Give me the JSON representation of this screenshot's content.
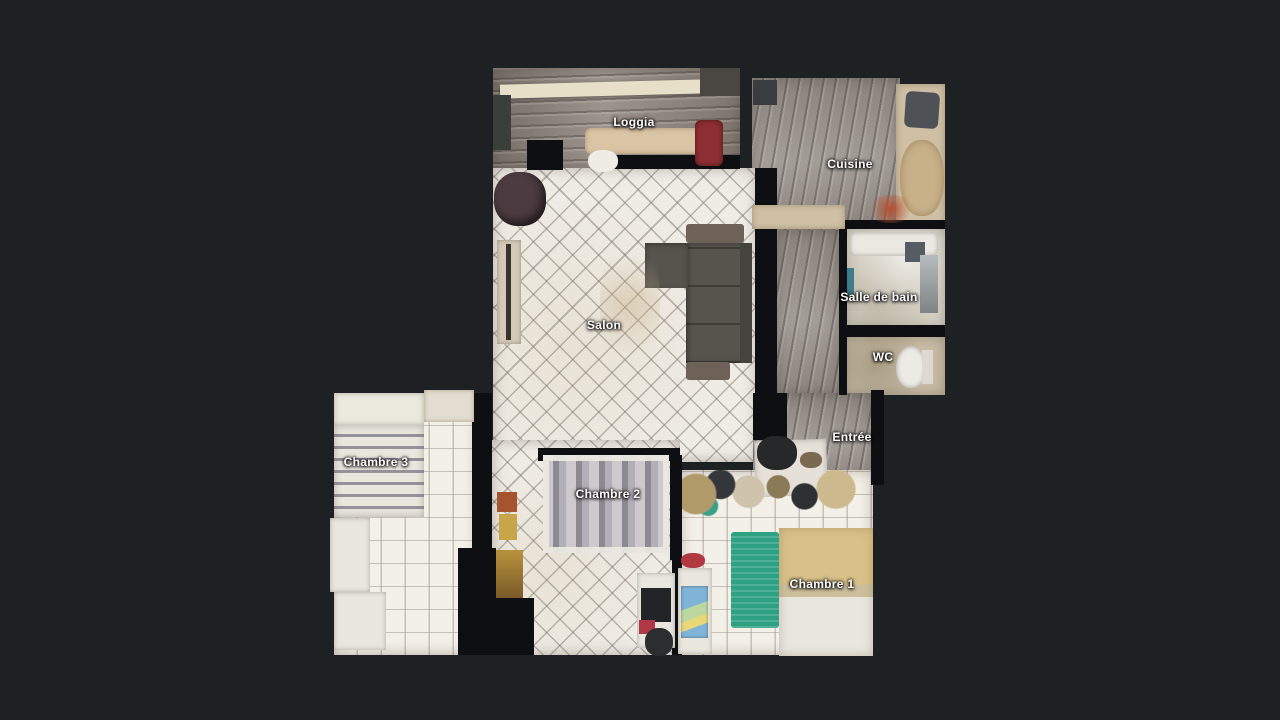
{
  "scene": {
    "type": "3d-dollhouse-floorplan",
    "background_color": "#1e2124",
    "wall_color": "#0d0f12"
  },
  "rooms": {
    "loggia": {
      "label": "Loggia"
    },
    "cuisine": {
      "label": "Cuisine"
    },
    "salon": {
      "label": "Salon"
    },
    "salle_de_bain": {
      "label": "Salle de bain"
    },
    "wc": {
      "label": "WC"
    },
    "entree": {
      "label": "Entrée"
    },
    "chambre1": {
      "label": "Chambre 1"
    },
    "chambre2": {
      "label": "Chambre 2"
    },
    "chambre3": {
      "label": "Chambre 3"
    }
  },
  "palette": {
    "tile_light": "#efece5",
    "wood_gray": "#99928c",
    "couch_gray": "#57544e",
    "rug_green": "#2ea183",
    "bed_yellow": "#d8c188",
    "bed_stripe_gray": "#8d8993",
    "counter_beige": "#cfc0a5",
    "label_text": "#ffffff"
  }
}
